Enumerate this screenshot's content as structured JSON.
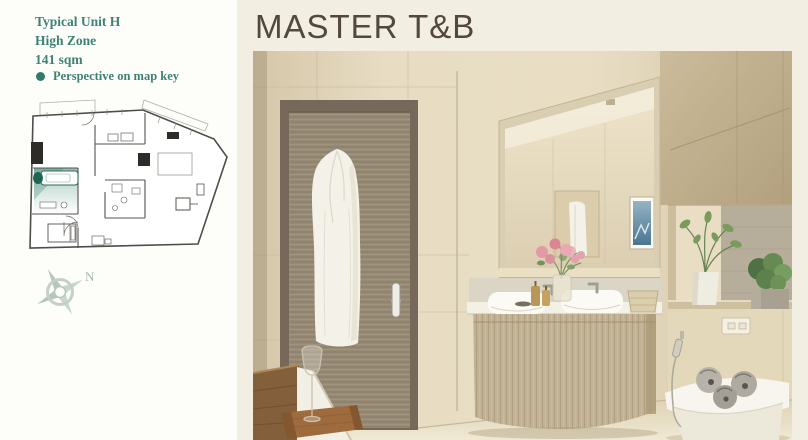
{
  "panel_left": {
    "unit": {
      "line1": "Typical Unit H",
      "line2": "High Zone",
      "line3": "141 sqm"
    },
    "legend": {
      "label": "Perspective on map key"
    },
    "compass": {
      "label": "N"
    },
    "colors": {
      "text": "#3F8273",
      "legend_dot": "#2F7D68",
      "plan_highlight": "#2F7A66",
      "plan_walls": "#4F4D48",
      "compass": "#B5C6BA",
      "background": "#FDFDFA"
    }
  },
  "panel_right": {
    "title": "MASTER T&B",
    "colors": {
      "title": "#52483D",
      "background": "#F2EEE2",
      "wall_tile": "#E6DABF",
      "door_wood": "#8D7E68",
      "vanity_wood": "#BFAE90",
      "mirror_frame": "#D7CBAE",
      "towel_gray": "#A9A59C",
      "plant_green": "#5D8449",
      "flower_pink": "#E493A2"
    }
  }
}
